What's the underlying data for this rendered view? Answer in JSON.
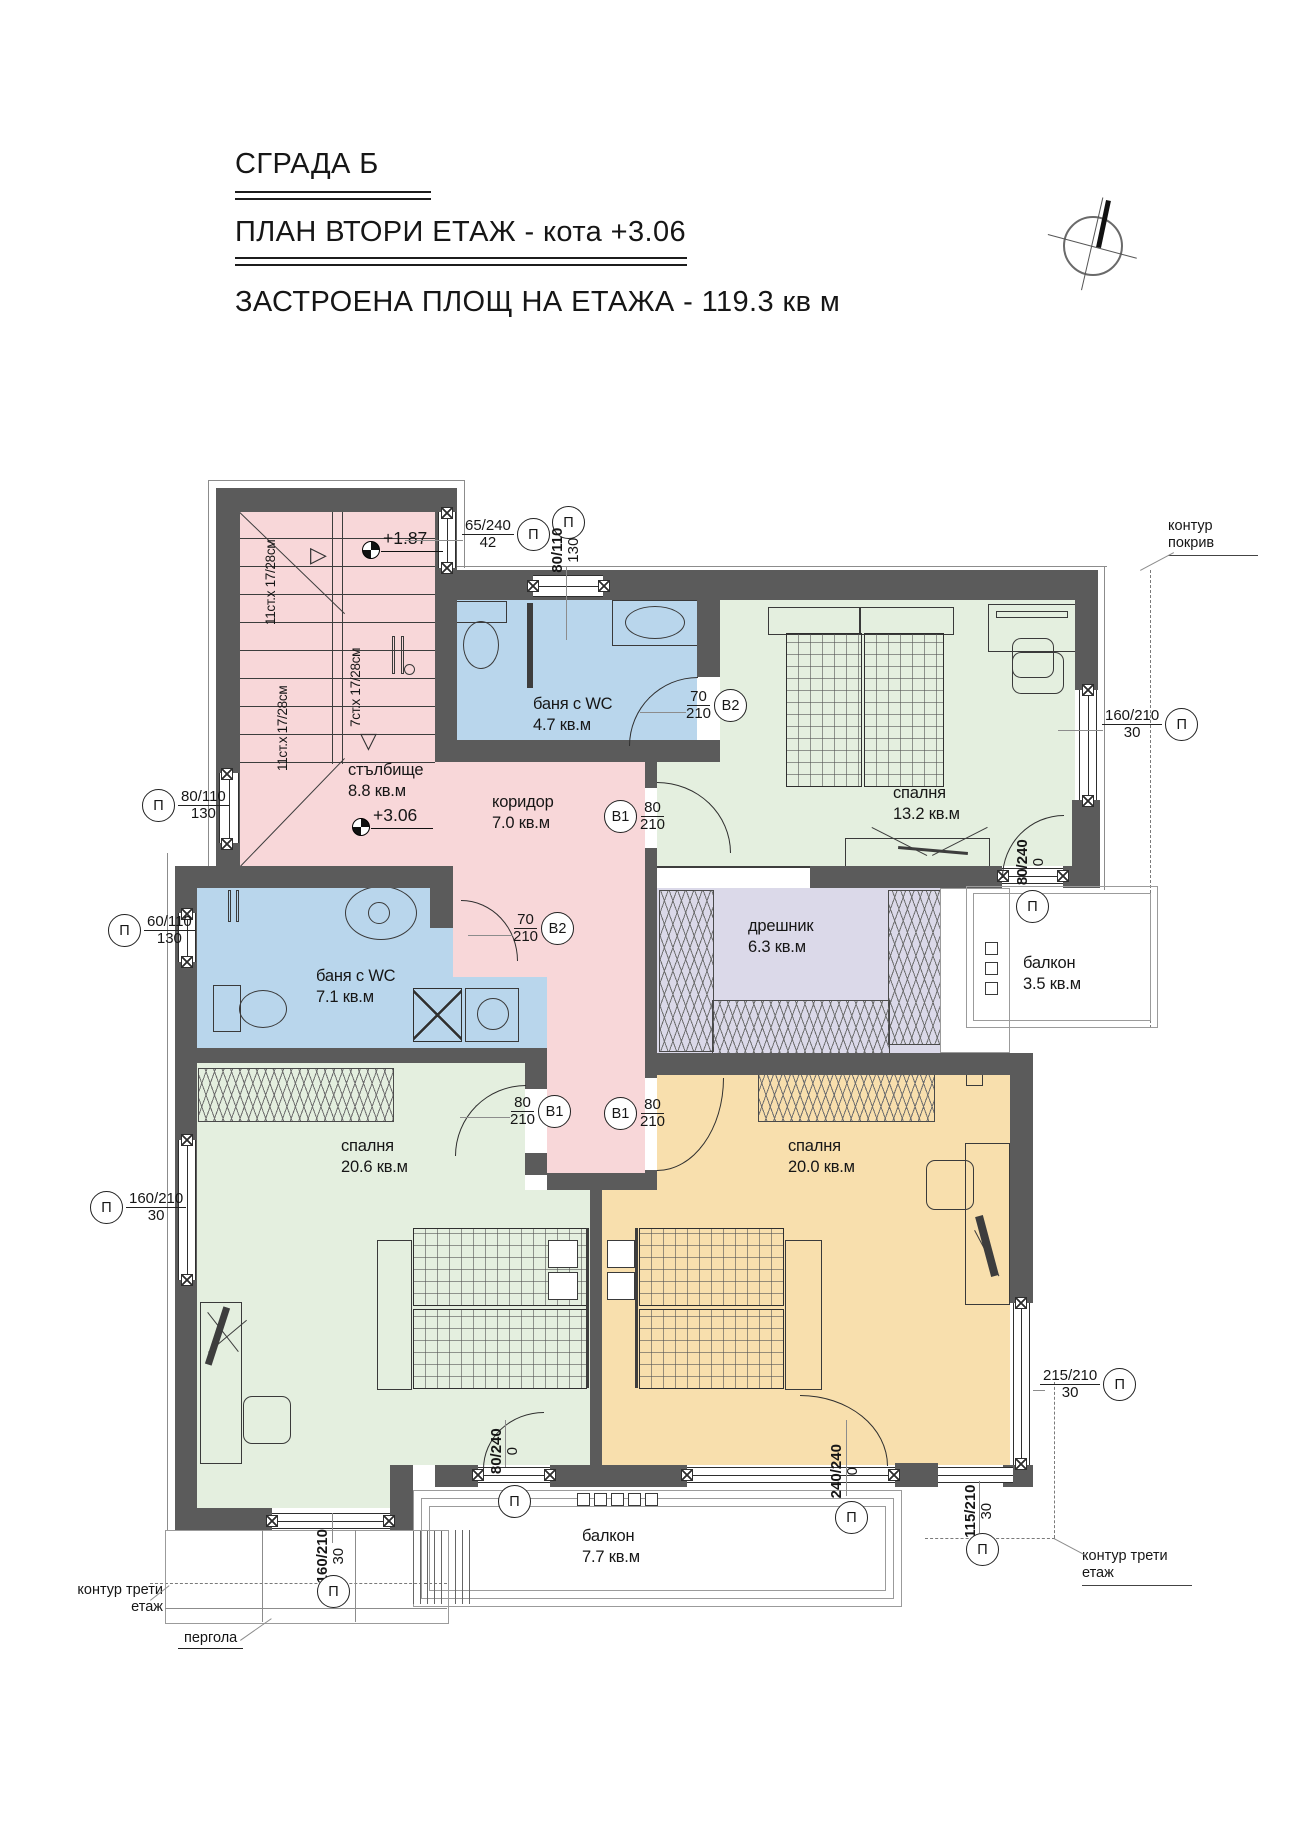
{
  "title": {
    "building": "СГРАДА Б",
    "plan": "ПЛАН ВТОРИ ЕТАЖ - кота +3.06",
    "area": "ЗАСТРОЕНА ПЛОЩ НА ЕТАЖА - 119.3 кв м"
  },
  "rooms": {
    "stair": {
      "name": "стълбище",
      "area": "8.8 кв.м"
    },
    "corridor": {
      "name": "коридор",
      "area": "7.0 кв.м"
    },
    "bath_top": {
      "name": "баня с WC",
      "area": "4.7 кв.м"
    },
    "bed_top": {
      "name": "спалня",
      "area": "13.2 кв.м"
    },
    "dressing": {
      "name": "дрешник",
      "area": "6.3 кв.м"
    },
    "balcony_right": {
      "name": "балкон",
      "area": "3.5 кв.м"
    },
    "bath_left": {
      "name": "баня с WC",
      "area": "7.1 кв.м"
    },
    "bed_left": {
      "name": "спалня",
      "area": "20.6 кв.м"
    },
    "bed_right": {
      "name": "спалня",
      "area": "20.0 кв.м"
    },
    "balcony_bottom": {
      "name": "балкон",
      "area": "7.7 кв.м"
    }
  },
  "levels": {
    "upper": "+1.87",
    "main": "+3.06"
  },
  "stairs": {
    "flight_a": "11ст.х 17/28см",
    "flight_b": "7ст.х 17/28см",
    "flight_c": "11ст.х 17/28см"
  },
  "openings": {
    "win_65_240": {
      "top": "65/240",
      "bottom": "42",
      "sym": "П"
    },
    "win_80_110_top": {
      "top": "80/110",
      "bottom": "130",
      "sym": "П"
    },
    "win_160_210_right": {
      "top": "160/210",
      "bottom": "30",
      "sym": "П"
    },
    "win_80_110_left": {
      "top": "80/110",
      "bottom": "130",
      "sym": "П"
    },
    "win_60_110_left": {
      "top": "60/110",
      "bottom": "130",
      "sym": "П"
    },
    "win_160_210_left": {
      "top": "160/210",
      "bottom": "30",
      "sym": "П"
    },
    "win_160_210_bot": {
      "top": "160/210",
      "bottom": "30",
      "sym": "П"
    },
    "door_80_240_right": {
      "top": "80/240",
      "bottom": "0",
      "sym": "П"
    },
    "door_80_240_bot": {
      "top": "80/240",
      "bottom": "0",
      "sym": "П"
    },
    "door_240_240": {
      "top": "240/240",
      "bottom": "0",
      "sym": "П"
    },
    "win_115_210": {
      "top": "115/210",
      "bottom": "30",
      "sym": "П"
    },
    "win_215_210": {
      "top": "215/210",
      "bottom": "30",
      "sym": "П"
    },
    "door_b2_top": {
      "top": "70",
      "bottom": "210",
      "sym": "B2"
    },
    "door_b2_left": {
      "top": "70",
      "bottom": "210",
      "sym": "B2"
    },
    "door_b1_bed_top": {
      "top": "80",
      "bottom": "210",
      "sym": "B1"
    },
    "door_b1_bed_left": {
      "top": "80",
      "bottom": "210",
      "sym": "B1"
    },
    "door_b1_bed_right": {
      "top": "80",
      "bottom": "210",
      "sym": "B1"
    }
  },
  "annotations": {
    "roof_contour": "контур покрив",
    "third_floor_right": "контур трети етаж",
    "third_floor_left": "контур трети етаж",
    "pergola": "пергола"
  },
  "icons": {
    "stair_arrow_down": "▽",
    "stair_arrow_up": "▷"
  }
}
